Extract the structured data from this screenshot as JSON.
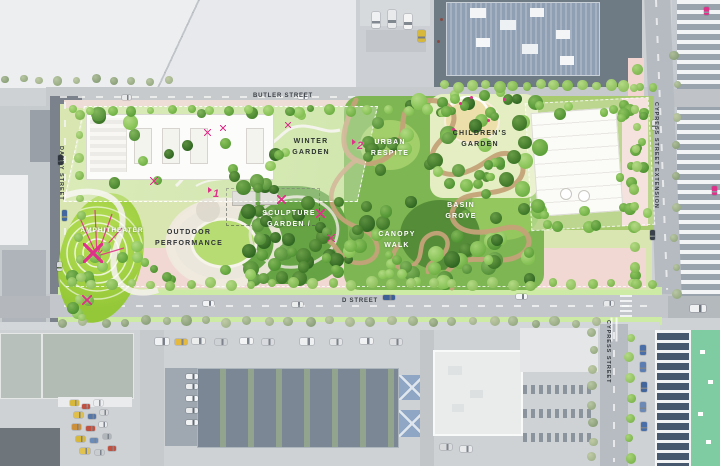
{
  "streets": {
    "butler": "BUTLER STREET",
    "d": "D STREET",
    "dandy": "DANDY STREET",
    "cypress_extension": "CYPRESS STREET EXTENSION",
    "cypress": "CYPRESS STREET"
  },
  "areas": {
    "winter_garden": "WINTER\nGARDEN",
    "urban_respite": "URBAN\nRESPITE",
    "childrens_garden": "CHILDREN'S\nGARDEN",
    "amphitheater": "AMPHITHEATER",
    "outdoor_performance": "OUTDOOR\nPERFORMANCE",
    "sculpture_garden": "SCULPTURE\nGARDEN /",
    "canopy_walk": "CANOPY\nWALK",
    "basin_grove": "BASIN\nGROVE"
  },
  "markers": {
    "one": "1",
    "two": "2"
  },
  "icons": {
    "marker_flag": "flag-triangle"
  },
  "colors": {
    "accent_pink": "#e0318a",
    "lawn_green": "#a8d44e",
    "canopy_path_tan": "#c4a278",
    "plaza_pink": "#f2d8d2"
  }
}
